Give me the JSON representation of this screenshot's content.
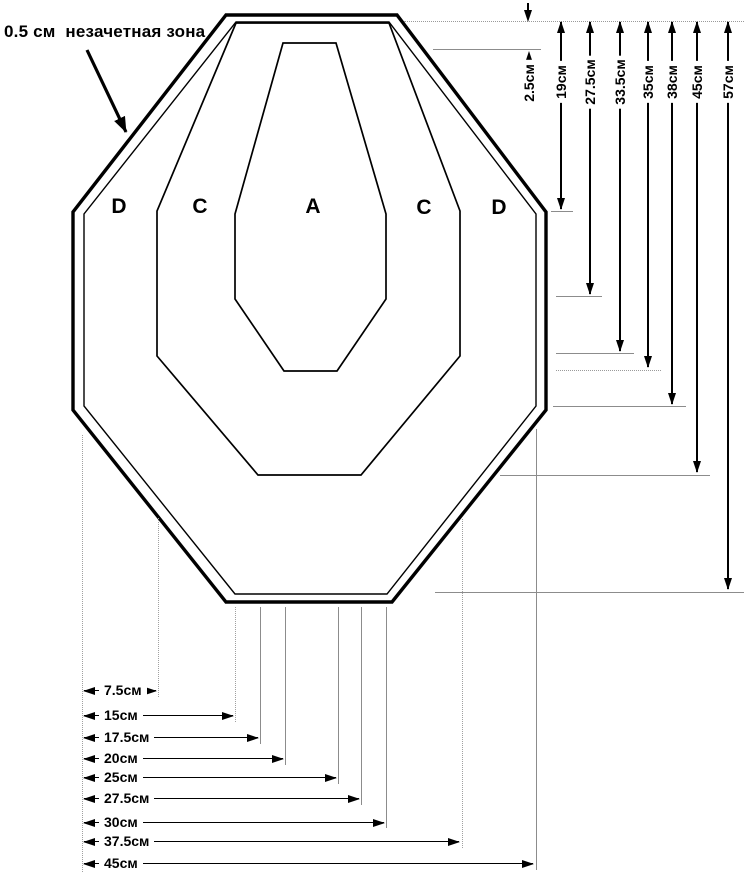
{
  "page": {
    "background": "#ffffff",
    "ink": "#000000",
    "guide_gray": "#8c8c8c"
  },
  "annotation": {
    "text": "0.5 см  незачетная зона"
  },
  "zone_labels": [
    {
      "label": "D",
      "x": 119,
      "y": 207
    },
    {
      "label": "C",
      "x": 200,
      "y": 207
    },
    {
      "label": "A",
      "x": 313,
      "y": 207
    },
    {
      "label": "C",
      "x": 424,
      "y": 208
    },
    {
      "label": "D",
      "x": 499,
      "y": 208
    }
  ],
  "dims_right": [
    {
      "label": "2.5см",
      "x": 529,
      "outside": true,
      "upper": {
        "y1": 3,
        "y2": 21
      },
      "lower": {
        "y1": 52,
        "y2": 112
      },
      "ref": {
        "y": 49,
        "x1": 433,
        "x2": 541
      }
    },
    {
      "label": "19см",
      "x": 561,
      "y_top": 22,
      "y_end": 209,
      "ref": {
        "y": 211,
        "x1": 551,
        "x2": 573
      }
    },
    {
      "label": "27.5см",
      "x": 590,
      "y_top": 22,
      "y_end": 294,
      "ref": {
        "y": 296,
        "x1": 556,
        "x2": 602
      }
    },
    {
      "label": "33.5см",
      "x": 620,
      "y_top": 22,
      "y_end": 351,
      "ref": {
        "y": 353,
        "x1": 556,
        "x2": 634
      }
    },
    {
      "label": "35см",
      "x": 648,
      "y_top": 22,
      "y_end": 367,
      "ref": {
        "y": 370,
        "x1": 556,
        "x2": 661,
        "dotted": true
      }
    },
    {
      "label": "38см",
      "x": 672,
      "y_top": 22,
      "y_end": 404,
      "ref": {
        "y": 406,
        "x1": 553,
        "x2": 686
      }
    },
    {
      "label": "45см",
      "x": 697,
      "y_top": 22,
      "y_end": 472,
      "ref": {
        "y": 475,
        "x1": 500,
        "x2": 710
      }
    },
    {
      "label": "57см",
      "x": 728,
      "y_top": 22,
      "y_end": 589,
      "ref": {
        "y": 592,
        "x1": 435,
        "x2": 744
      }
    }
  ],
  "dims_bottom": [
    {
      "label": "7.5см",
      "y": 690,
      "x1": 84,
      "x2": 156,
      "ext": {
        "x": 158,
        "y1": 518,
        "y2": 697,
        "dotted": true
      }
    },
    {
      "label": "15см",
      "y": 715,
      "x1": 84,
      "x2": 233,
      "ext": {
        "x": 235,
        "y1": 607,
        "y2": 722,
        "dotted": true
      }
    },
    {
      "label": "17.5см",
      "y": 737,
      "x1": 84,
      "x2": 258,
      "ext": {
        "x": 260,
        "y1": 607,
        "y2": 744
      }
    },
    {
      "label": "20см",
      "y": 758,
      "x1": 84,
      "x2": 283,
      "ext": {
        "x": 285,
        "y1": 607,
        "y2": 765
      }
    },
    {
      "label": "25см",
      "y": 777,
      "x1": 84,
      "x2": 336,
      "ext": {
        "x": 338,
        "y1": 607,
        "y2": 784
      }
    },
    {
      "label": "27.5см",
      "y": 798,
      "x1": 84,
      "x2": 359,
      "ext": {
        "x": 361,
        "y1": 607,
        "y2": 805
      }
    },
    {
      "label": "30см",
      "y": 822,
      "x1": 84,
      "x2": 384,
      "ext": {
        "x": 386,
        "y1": 607,
        "y2": 828
      }
    },
    {
      "label": "37.5см",
      "y": 841,
      "x1": 84,
      "x2": 459,
      "ext": {
        "x": 462,
        "y1": 519,
        "y2": 848,
        "dotted": true
      }
    },
    {
      "label": "45см",
      "y": 863,
      "x1": 84,
      "x2": 533,
      "ext": {
        "x": 536,
        "y1": 429,
        "y2": 870
      }
    }
  ],
  "guides": {
    "top_ref": {
      "y": 21,
      "x1": 404,
      "x2": 744,
      "dotted": true
    },
    "left_ref": {
      "x": 82,
      "y1": 435,
      "y2": 872,
      "dotted": true
    }
  }
}
